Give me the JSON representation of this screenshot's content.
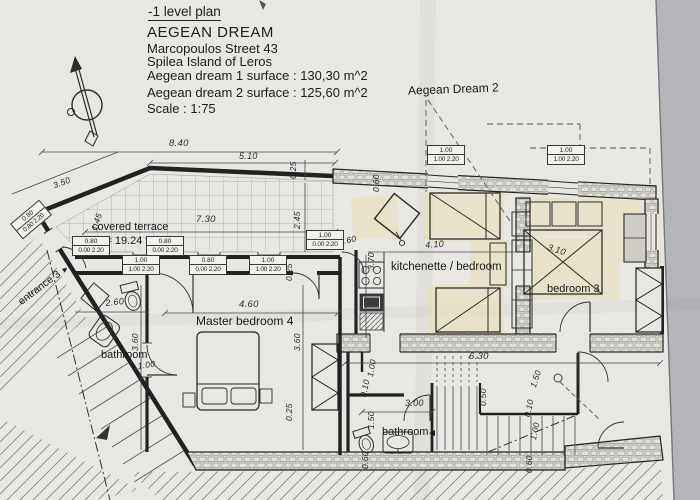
{
  "photo": {
    "background": "#b3b5b9",
    "paper": "#e9e7e3"
  },
  "title_block": {
    "plan_level": "-1 level plan",
    "project": "AEGEAN DREAM",
    "street": "Marcopoulos Street 43",
    "island": "Spilea Island of  Leros",
    "surface_1": "Aegean dream 1 surface : 130,30 m^2",
    "surface_2": "Aegean dream 2 surface : 125,60 m^2",
    "scale": "Scale : 1:75"
  },
  "area_labels": {
    "aegean_dream_2": "Aegean Dream 2",
    "covered_terrace": "covered terrace",
    "terrace_area": "E = 19.24 τμ",
    "entrance": "entrance 3",
    "entrance_arrow": "►",
    "kitchenette": "kitchenette / bedroom",
    "bedroom_3": "bedroom 3",
    "master_bedroom": "Master bedroom 4",
    "bathroom_upper": "bathroom",
    "bathroom_lower": "bathroom",
    "bathroom_arrow": "◄"
  },
  "dims": [
    "8.40",
    "5.10",
    "3.50",
    "0.25",
    "7.30",
    "2.45",
    "0.60",
    "0.60",
    "3.70",
    "4.10",
    "3.10",
    "2.60",
    "4.60",
    "3.60",
    "3.60",
    "1.00",
    "0.25",
    "0.25",
    "6.30",
    "1.00",
    "0.10",
    "3.00",
    "1.50",
    "0.60",
    "1.50",
    "0.50",
    "0.10",
    "1.00",
    "0.60",
    "1.45"
  ],
  "opening_tags": [
    {
      "size": "0.80",
      "detail": "0.80 2.20"
    },
    {
      "size": "0.80",
      "detail": "0.00 2.20"
    },
    {
      "size": "0.80",
      "detail": "0.00 2.20"
    },
    {
      "size": "1.00",
      "detail": "0.00 2.20"
    },
    {
      "size": "1.00",
      "detail": "1.00 2.20"
    },
    {
      "size": "0.80",
      "detail": "0.00 2.20"
    },
    {
      "size": "1.00",
      "detail": "1.00 2.20"
    },
    {
      "size": "1.00",
      "detail": "1.00 2.20"
    },
    {
      "size": "1.00",
      "detail": "1.00 2.20"
    }
  ]
}
